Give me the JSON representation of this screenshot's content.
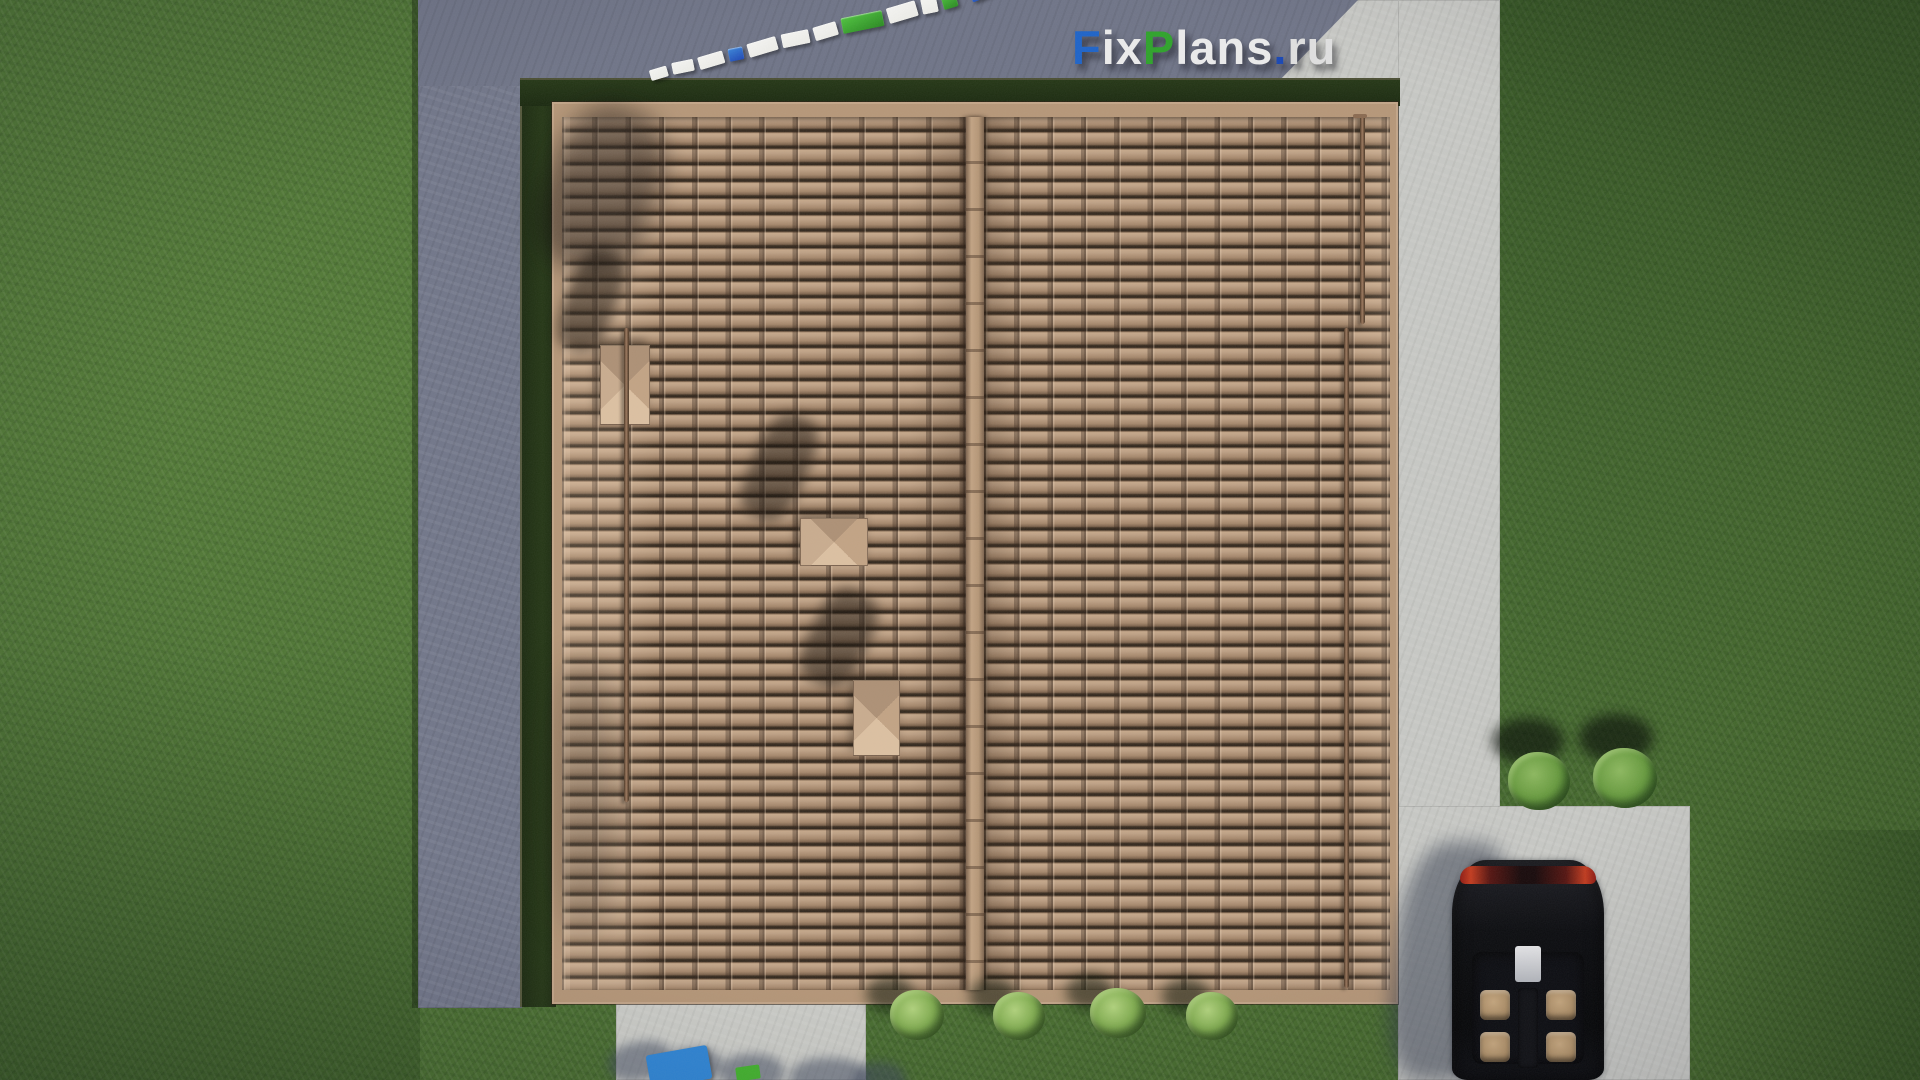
{
  "watermark": {
    "text": "FixPlans.ru",
    "segments": [
      {
        "text": "F",
        "color": "#1d63c8"
      },
      {
        "text": "ix",
        "color": "#ececec"
      },
      {
        "text": "P",
        "color": "#2ea32a"
      },
      {
        "text": "lans",
        "color": "#ececec"
      },
      {
        "text": ".",
        "color": "#1746b4"
      },
      {
        "text": "ru",
        "color": "#e0e0e0"
      }
    ]
  },
  "scene": {
    "description": "Top-down 3D architectural render of a house gable roof with brown clay tiles, concrete blind-area paths, lawn, parked black car and shrubs",
    "lawn_color": "#4e7434",
    "concrete_lit_color": "#c7c8c4",
    "concrete_shadow_color": "#717689",
    "roof": {
      "tile_color": "#b09072",
      "ridge_color": "#bb9c7e",
      "eave_color": "#b69778",
      "slopes": 2,
      "roof_vents": 3,
      "snow_guard_pipes": 3
    },
    "car": {
      "view": "top view, parked on driveway",
      "body_color": "#0b0c0f",
      "interior_color": "#bfa078",
      "taillight_color": "#b3291a"
    },
    "shrubs": {
      "front_row_count": 4,
      "side_pair_count": 2
    },
    "scale_bar": {
      "segment_colors": [
        "#f0f0ec",
        "#f0f0ec",
        "#f0f0ec",
        "#2a62c4",
        "#f0f0ec",
        "#f0f0ec",
        "#f0f0ec",
        "#3aa32e",
        "#f0f0ec",
        "#f0f0ec",
        "#3aa32e",
        "#2a62c4"
      ]
    },
    "bottom_marker": {
      "blue": "#2f86d6",
      "green": "#43b32e"
    }
  }
}
